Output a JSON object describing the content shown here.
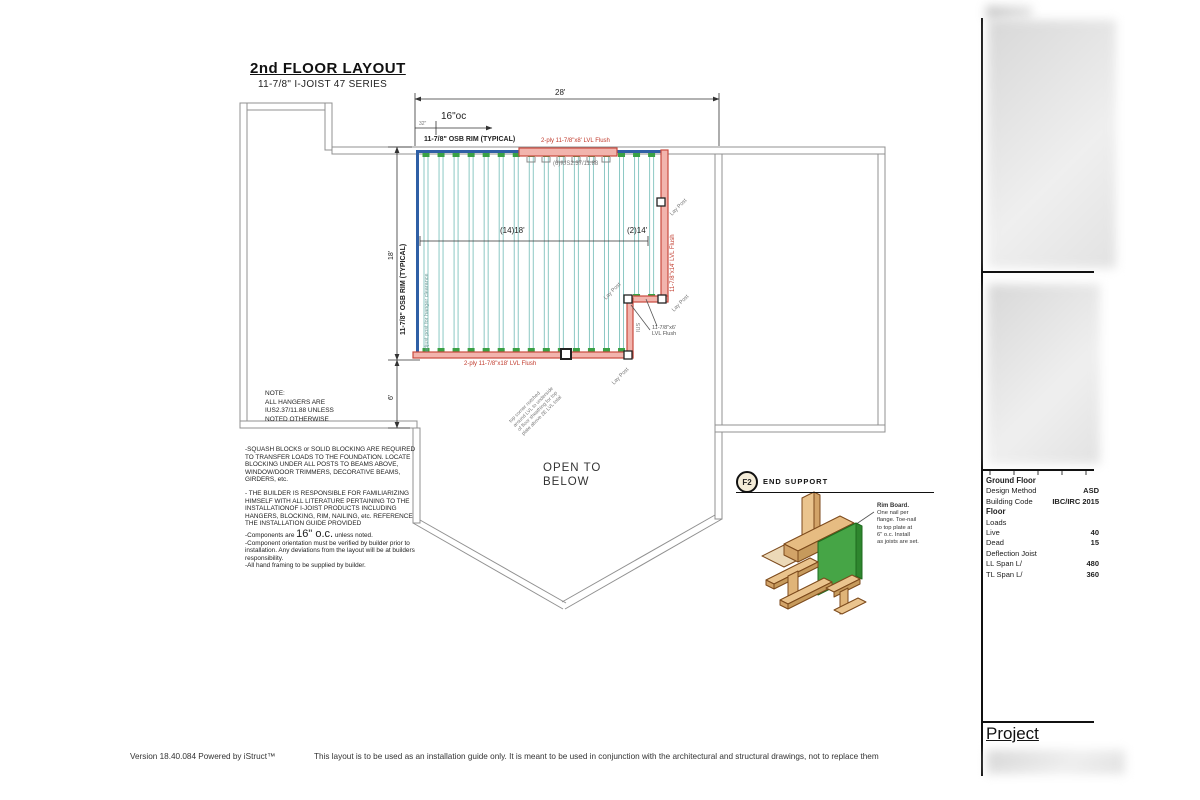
{
  "title": {
    "main": "2nd FLOOR LAYOUT",
    "subtitle": "11-7/8\" I-JOIST 47 SERIES"
  },
  "dimensions": {
    "top_span": "28'",
    "spacing": "16\"oc",
    "offset": "32\"",
    "left_height": "18'",
    "left_lower": "6'",
    "mid_span_left": "(14)18'",
    "mid_span_right": "(2)14'"
  },
  "plan": {
    "joist_count_long": 14,
    "joist_count_short": 2,
    "labels": {
      "osb_rim_top": "11-7/8\" OSB RIM (TYPICAL)",
      "osb_rim_left": "11-7/8\" OSB RIM (TYPICAL)",
      "lvl_header_top": "2-ply 11-7/8\"x8' LVL Flush",
      "hangers_top": "(6)IUS2.37/11.88",
      "lvl_right": "11-7/8\"x14' LVL Flush",
      "lvl_step_line1": "11-7/8\"x6'",
      "lvl_step_line2": "LVL Flush",
      "lvl_bottom": "2-ply 11-7/8\"x18' LVL Flush",
      "lay_post": "Lay Post",
      "ius_small": "IUS",
      "adjust_post": "adjust post for hanger clearance",
      "notch_l1": "top corner notched",
      "notch_l2": "around LVL to underside",
      "notch_l3": "of floor sheathing for top",
      "notch_l4": "plate above 2E LVL total",
      "open_below": "OPEN TO\nBELOW"
    }
  },
  "note_block": {
    "l1": "NOTE:",
    "l2": "ALL HANGERS ARE",
    "l3": "IUS2.37/11.88 UNLESS",
    "l4": "NOTED OTHERWISE"
  },
  "notes": {
    "p1": "-SQUASH BLOCKS or SOLID BLOCKING ARE REQUIRED TO TRANSFER LOADS TO THE FOUNDATION. LOCATE BLOCKING UNDER ALL POSTS TO BEAMS ABOVE, WINDOW/DOOR TRIMMERS, DECORATIVE BEAMS, GIRDERS, etc.",
    "p2": "- THE BUILDER IS RESPONSIBLE FOR FAMILIARIZING HIMSELF WITH ALL LITERATURE PERTAINING TO THE INSTALLATIONOF I-JOIST PRODUCTS INCLUDING HANGERS, BLOCKING, RIM, NAILING, etc. REFERENCE THE INSTALLATION GUIDE PROVIDED",
    "p3_pre": "-Components are ",
    "p3_big": "16\" o.c.",
    "p3_post": " unless noted.",
    "p4": "-Component orientation must be verified by builder prior to installation. Any deviations from the layout will be at builders responsibility.",
    "p5": "-All hand framing to be supplied by builder."
  },
  "detail": {
    "tag": "F2",
    "title": "END SUPPORT",
    "label_title": "Rim Board.",
    "label_l1": "One nail per",
    "label_l2": "flange. Toe-nail",
    "label_l3": "to top plate at",
    "label_l4": "6\" o.c.  Install",
    "label_l5": "as joists are set."
  },
  "sidebar": {
    "rows": [
      {
        "label": "Ground Floor",
        "value": "",
        "bold": true
      },
      {
        "label": "Design Method",
        "value": "ASD"
      },
      {
        "label": "Building Code",
        "value": "IBC/IRC 2015"
      },
      {
        "label": "Floor",
        "value": "",
        "bold": true
      },
      {
        "label": "Loads",
        "value": ""
      },
      {
        "label": "Live",
        "value": "40"
      },
      {
        "label": "Dead",
        "value": "15"
      },
      {
        "label": "Deflection Joist",
        "value": ""
      },
      {
        "label": "LL Span  L/",
        "value": "480"
      },
      {
        "label": "TL Span  L/",
        "value": "360"
      }
    ],
    "project": "Project"
  },
  "footer": {
    "version": "Version 18.40.084 Powered by iStruct™",
    "disclaimer": "This layout is to be used as an installation guide only.  It is meant to be used in conjunction with the architectural and structural drawings, not to replace them"
  },
  "colors": {
    "joist_teal": "#8cc8c4",
    "hanger_green": "#3aa145",
    "rim_blue": "#2f5fa5",
    "lvl_red": "#c9493e",
    "lvl_fill": "#f2b4ad",
    "wall_gray": "#909090",
    "detail_green": "#46a546",
    "wood_tan": "#eac48e"
  }
}
